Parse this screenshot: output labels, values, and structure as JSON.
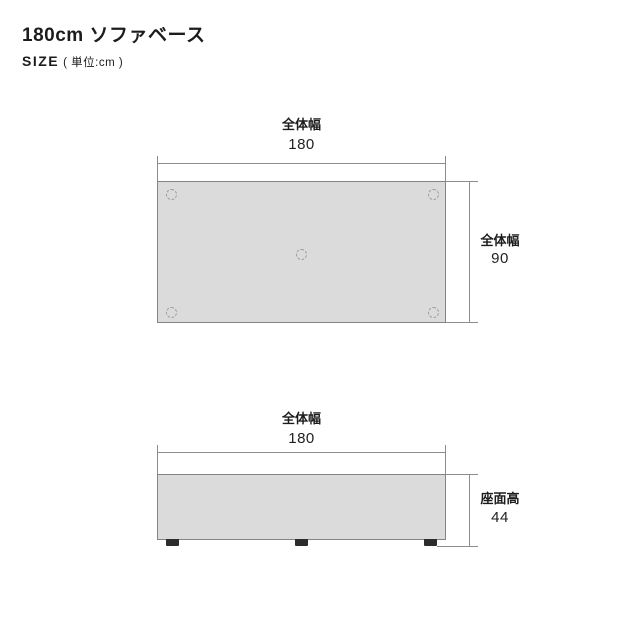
{
  "header": {
    "title": "180cm ソファベース",
    "size_label": "SIZE",
    "unit_note": "( 単位:cm )"
  },
  "top_view": {
    "width_label": "全体幅",
    "width_value": "180",
    "depth_label": "全体幅",
    "depth_value": "90"
  },
  "side_view": {
    "width_label": "全体幅",
    "width_value": "180",
    "seat_height_label": "座面高",
    "seat_height_value": "44"
  },
  "colors": {
    "surface_fill": "#dbdbdb",
    "line": "#8c8c8c",
    "rect_border": "#848484",
    "circle_border": "#9e9e9e",
    "foot": "#2c2c2c",
    "text": "#1c1c1c"
  }
}
